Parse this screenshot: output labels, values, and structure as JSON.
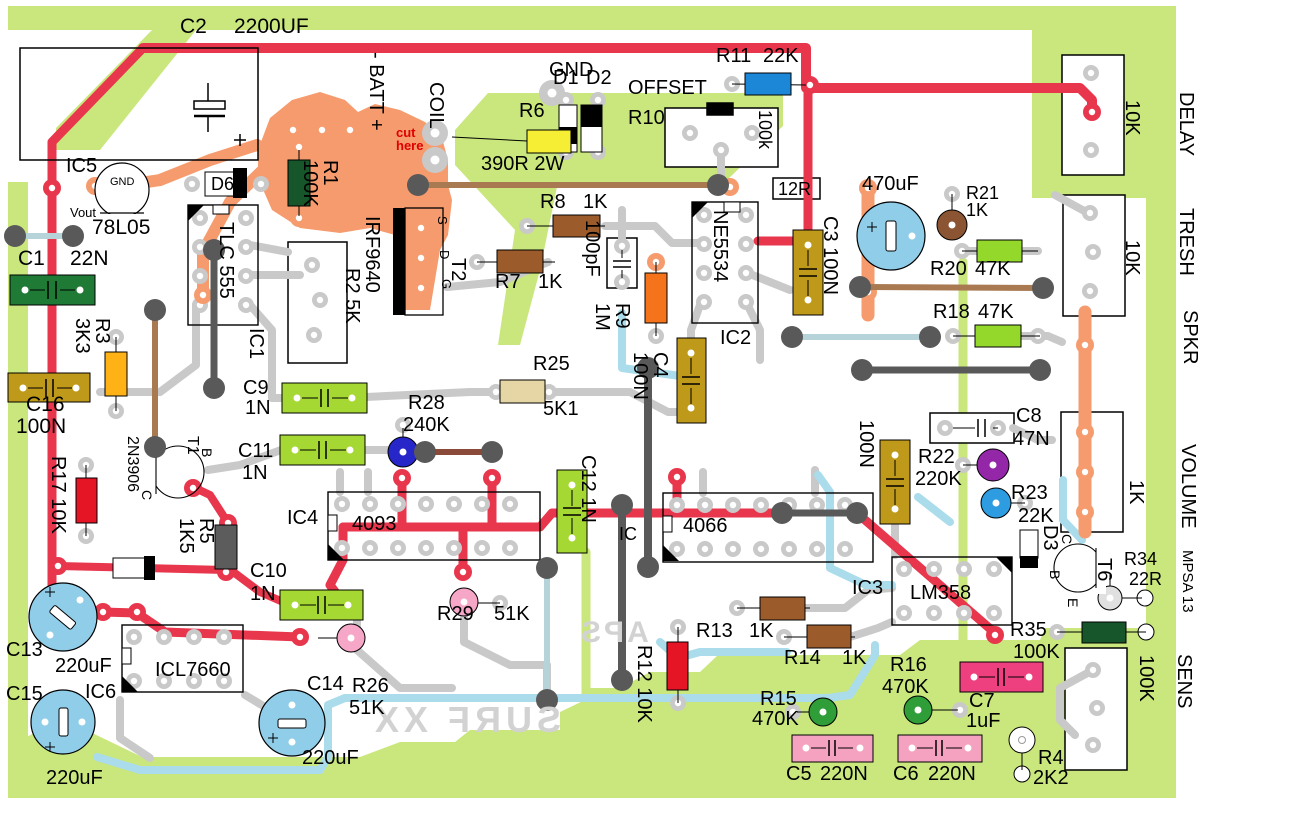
{
  "type": "pcb-component-layout-diagram",
  "silkscreen": {
    "product_mirrored": "SURF XX",
    "brand_mirrored": "APS"
  },
  "colors": {
    "board_pour_green": "#c9e77d",
    "trace_gray": "#c9c9c9",
    "trace_red": "#e8364c",
    "trace_blue": "#aadcec",
    "pour_orange": "#f59b6d",
    "electrolytic_blue": "#90cde8",
    "cap_green": "#a5d832",
    "cap_olive": "#bf9a1a",
    "cap_pink": "#f4a2c0",
    "cap_magenta": "#ee3f7e",
    "resistor_brown": "#9b5b2b",
    "resistor_green": "#93d82b",
    "resistor_red": "#e51526",
    "resistor_blue": "#1b87d6",
    "resistor_yellow": "#f5ee35",
    "resistor_orange": "#f5731a"
  },
  "labels": {
    "c2": "C2",
    "c2_val": "2200UF",
    "ic5": "IC5",
    "reg_gnd": "GND",
    "reg_vout": "Vout",
    "reg": "78L05",
    "c1": "C1",
    "c1_val": "22N",
    "d6": "D6",
    "r1": "R1\n100K",
    "batt": "- BATT +",
    "cut": "cut\nhere",
    "coil": "COIL",
    "gnd_top": "GND",
    "d1": "D1",
    "d2": "D2",
    "r6": "R6",
    "r6_val": "390R 2W",
    "offset": "OFFSET",
    "r10": "R10",
    "r10_val": "100k",
    "r11": "R11",
    "r11_val": "22K",
    "r8": "R8",
    "r8_val": "1K",
    "r7": "R7",
    "r7_val": "1K",
    "c_100pf": "100pF",
    "t2": "T2",
    "t2_s": "S",
    "t2_d": "D",
    "t2_g": "G",
    "irf": "IRF9640",
    "tlc": "TLC 555",
    "ic1": "IC1",
    "r2": "R2 5K",
    "r3": "R3\n3K3",
    "c16": "C16",
    "c16_val": "100N",
    "r17": "R17 10K",
    "t1_part": "2N3906",
    "t1": "T1",
    "t1_b": "B",
    "t1_c": "C",
    "r5": "R5\n1K5",
    "c9": "C9",
    "c9_val": "1N",
    "c11": "C11",
    "c11_val": "1N",
    "r28": "R28",
    "r28_val": "240K",
    "r25": "R25",
    "r25_val": "5K1",
    "r9": "R9\n1M",
    "ne5534": "NE5534",
    "ic2": "IC2",
    "c3": "C3 100N",
    "c4": "C4\n100N",
    "c12": "C12 1N",
    "r12r": "12R",
    "c470": "470uF",
    "r21": "R21",
    "r21_val": "1K",
    "r20": "R20",
    "r20_val": "47K",
    "r18": "R18",
    "r18_val": "47K",
    "delay_val": "10K",
    "delay": "DELAY",
    "tresh_val": "10K",
    "tresh": "TRESH",
    "spkr": "SPKR",
    "c8": "C8",
    "c8_val": "47N",
    "cap100n": "100N",
    "r22": "R22",
    "r22_val": "220K",
    "r23": "R23",
    "r23_val": "22K",
    "volume_val": "1K",
    "volume": "VOLUME",
    "d3": "D3",
    "t6": "T6",
    "t6_c": "C",
    "t6_b": "B",
    "t6_e": "E",
    "r34": "R34",
    "r34_val": "22R",
    "mpsa": "MPSA 13",
    "r35": "R35",
    "r35_val": "100K",
    "sens_val": "100K",
    "sens": "SENS",
    "ic3": "IC3",
    "lm358": "LM358",
    "ic_4066": "IC",
    "n4066": "4066",
    "ic4": "IC4",
    "n4093": "4093",
    "r13": "R13",
    "r13_val": "1K",
    "r14": "R14",
    "r14_val": "1K",
    "r12": "R12 10K",
    "r16": "R16",
    "r16_val": "470K",
    "c7": "C7",
    "c7_val": "1uF",
    "r4": "R4",
    "r4_val": "2K2",
    "c6": "C6",
    "c6_val": "220N",
    "c5": "C5",
    "c5_val": "220N",
    "r15": "R15",
    "r15_val": "470K",
    "r29": "R29",
    "r29_val": "51K",
    "r26": "R26",
    "r26_val": "51K",
    "c14": "C14",
    "c14_val": "220uF",
    "c13": "C13",
    "c13_val": "220uF",
    "c15": "C15",
    "c15_val": "220uF",
    "ic6": "IC6",
    "icl": "ICL7660",
    "c10": "C10",
    "c10_val": "1N",
    "surf": "SURF XX",
    "aps": "APS"
  }
}
